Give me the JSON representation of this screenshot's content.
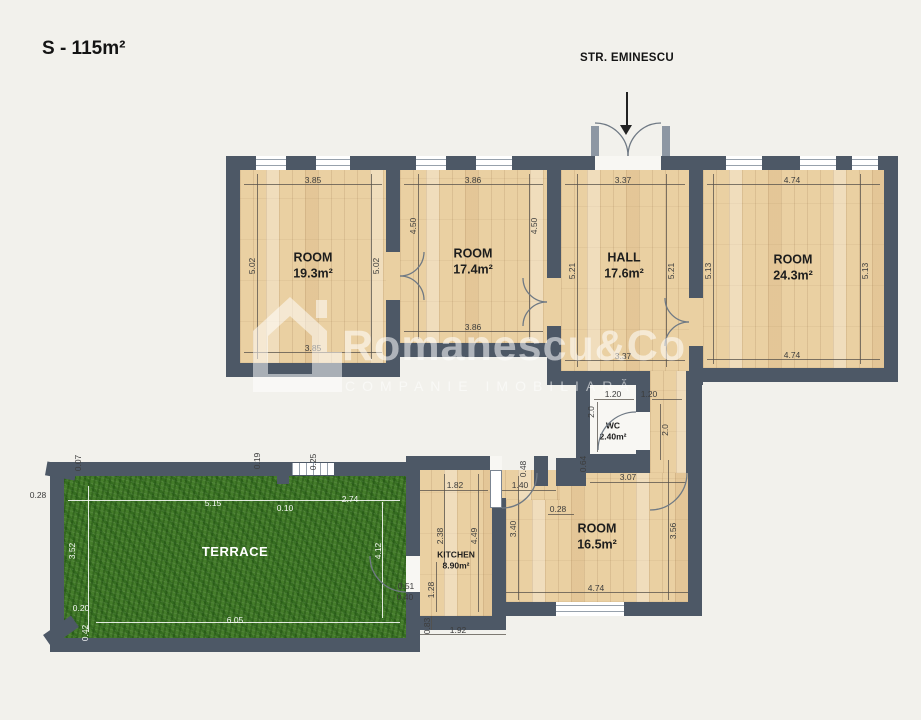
{
  "title": "S - 115m²",
  "street_label": "STR. EMINESCU",
  "watermark": {
    "brand": "Romanescu&Co",
    "subtitle": "COMPANIE IMOBILIARĂ"
  },
  "colors": {
    "wall": "#4d5866",
    "wood": "#ead0a2",
    "grass": "#447c2a",
    "background": "#f2f1ec",
    "dim_text": "#3c3c3c"
  },
  "rooms": [
    {
      "name": "ROOM",
      "area": "19.3m²",
      "x": 313,
      "y": 266
    },
    {
      "name": "ROOM",
      "area": "17.4m²",
      "x": 473,
      "y": 262
    },
    {
      "name": "HALL",
      "area": "17.6m²",
      "x": 624,
      "y": 266
    },
    {
      "name": "ROOM",
      "area": "24.3m²",
      "x": 793,
      "y": 268
    },
    {
      "name": "WC",
      "area": "2.40m²",
      "x": 613,
      "y": 431,
      "small": true
    },
    {
      "name": "KITCHEN",
      "area": "8.90m²",
      "x": 456,
      "y": 560,
      "small": true
    },
    {
      "name": "ROOM",
      "area": "16.5m²",
      "x": 597,
      "y": 537
    },
    {
      "name": "TERRACE",
      "area": "",
      "x": 235,
      "y": 552,
      "light": true
    }
  ],
  "dims": [
    {
      "t": "3.85",
      "x": 313,
      "y": 180
    },
    {
      "t": "5.02",
      "x": 252,
      "y": 266,
      "r": 1
    },
    {
      "t": "5.02",
      "x": 376,
      "y": 266,
      "r": 1
    },
    {
      "t": "3.85",
      "x": 313,
      "y": 348
    },
    {
      "t": "3.86",
      "x": 473,
      "y": 180
    },
    {
      "t": "4.50",
      "x": 413,
      "y": 226,
      "r": 1
    },
    {
      "t": "4.50",
      "x": 534,
      "y": 226,
      "r": 1
    },
    {
      "t": "3.86",
      "x": 473,
      "y": 327
    },
    {
      "t": "3.37",
      "x": 623,
      "y": 180
    },
    {
      "t": "5.21",
      "x": 572,
      "y": 271,
      "r": 1
    },
    {
      "t": "5.21",
      "x": 671,
      "y": 271,
      "r": 1
    },
    {
      "t": "3.37",
      "x": 623,
      "y": 356
    },
    {
      "t": "4.74",
      "x": 792,
      "y": 180
    },
    {
      "t": "5.13",
      "x": 708,
      "y": 271,
      "r": 1
    },
    {
      "t": "5.13",
      "x": 865,
      "y": 271,
      "r": 1
    },
    {
      "t": "4.74",
      "x": 792,
      "y": 355
    },
    {
      "t": "1.20",
      "x": 613,
      "y": 394
    },
    {
      "t": "1.20",
      "x": 649,
      "y": 394
    },
    {
      "t": "2.0",
      "x": 591,
      "y": 412,
      "r": 1
    },
    {
      "t": "2.0",
      "x": 665,
      "y": 430,
      "r": 1
    },
    {
      "t": "0.64",
      "x": 583,
      "y": 464,
      "r": 1
    },
    {
      "t": "3.07",
      "x": 628,
      "y": 477
    },
    {
      "t": "0.48",
      "x": 523,
      "y": 469,
      "r": 1
    },
    {
      "t": "1.40",
      "x": 520,
      "y": 485
    },
    {
      "t": "1.82",
      "x": 455,
      "y": 485
    },
    {
      "t": "0.28",
      "x": 558,
      "y": 509
    },
    {
      "t": "2.38",
      "x": 440,
      "y": 536,
      "r": 1
    },
    {
      "t": "4.49",
      "x": 474,
      "y": 536,
      "r": 1
    },
    {
      "t": "3.40",
      "x": 513,
      "y": 529,
      "r": 1
    },
    {
      "t": "3.56",
      "x": 673,
      "y": 531,
      "r": 1
    },
    {
      "t": "4.74",
      "x": 596,
      "y": 588
    },
    {
      "t": "0.51",
      "x": 406,
      "y": 586
    },
    {
      "t": "0.40",
      "x": 405,
      "y": 597
    },
    {
      "t": "1.28",
      "x": 431,
      "y": 590,
      "r": 1
    },
    {
      "t": "0.83",
      "x": 427,
      "y": 626,
      "r": 1
    },
    {
      "t": "1.92",
      "x": 458,
      "y": 630
    },
    {
      "t": "0.07",
      "x": 78,
      "y": 463,
      "r": 1
    },
    {
      "t": "0.28",
      "x": 38,
      "y": 495
    },
    {
      "t": "0.19",
      "x": 257,
      "y": 461,
      "r": 1
    },
    {
      "t": "0.25",
      "x": 313,
      "y": 462,
      "r": 1
    },
    {
      "t": "5.15",
      "x": 213,
      "y": 503,
      "w": 1
    },
    {
      "t": "0.10",
      "x": 285,
      "y": 508,
      "w": 1
    },
    {
      "t": "2.74",
      "x": 350,
      "y": 499,
      "w": 1
    },
    {
      "t": "3.52",
      "x": 72,
      "y": 551,
      "r": 1,
      "w": 1
    },
    {
      "t": "4.12",
      "x": 378,
      "y": 551,
      "r": 1,
      "w": 1
    },
    {
      "t": "0.20",
      "x": 81,
      "y": 608,
      "w": 1
    },
    {
      "t": "0.42",
      "x": 85,
      "y": 633,
      "r": 1,
      "w": 1
    },
    {
      "t": "6.05",
      "x": 235,
      "y": 620,
      "w": 1
    }
  ]
}
